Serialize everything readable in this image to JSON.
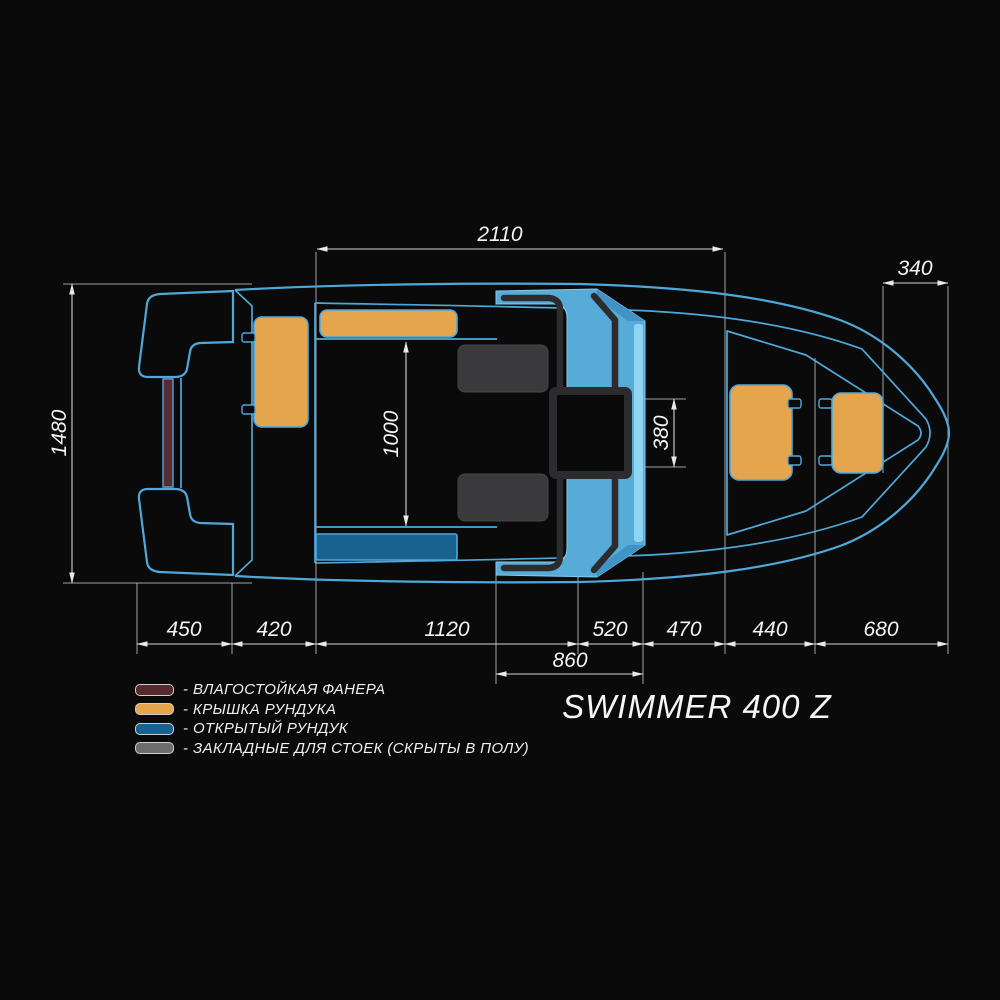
{
  "title": "SWIMMER 400 Z",
  "legend": {
    "items": [
      {
        "label": "- ВЛАГОСТОЙКАЯ ФАНЕРА",
        "color": "#572A2E"
      },
      {
        "label": "- КРЫШКА РУНДУКА",
        "color": "#E5A54D"
      },
      {
        "label": "- ОТКРЫТЫЙ РУНДУК",
        "color": "#19618F"
      },
      {
        "label": "- ЗАКЛАДНЫЕ ДЛЯ СТОЕК (СКРЫТЫ В ПОЛУ)",
        "color": "#6C6C6E"
      }
    ]
  },
  "dimensions": {
    "overall_cockpit_length": "2110",
    "bow_section": "340",
    "beam": "1480",
    "cockpit_opening_length": "1000",
    "walkthrough_width": "380",
    "console_total": "860",
    "bottom_chain": [
      "450",
      "420",
      "1120",
      "520",
      "470",
      "440",
      "680"
    ]
  },
  "colors": {
    "background": "#0A0A0A",
    "outline_blue": "#4FA8DA",
    "windshield_cyan": "#57ABD7",
    "windshield_highlight": "#90D4F4",
    "frame_dark": "#2C2C2E",
    "lid_orange": "#E5A54D",
    "locker_blue": "#19618F",
    "plywood_maroon": "#572A2E",
    "seat_plate_gray": "#3A3A3C",
    "legend_gray": "#6C6C6E",
    "dim_line": "#D4D7D9",
    "text": "#F4F4F4"
  }
}
